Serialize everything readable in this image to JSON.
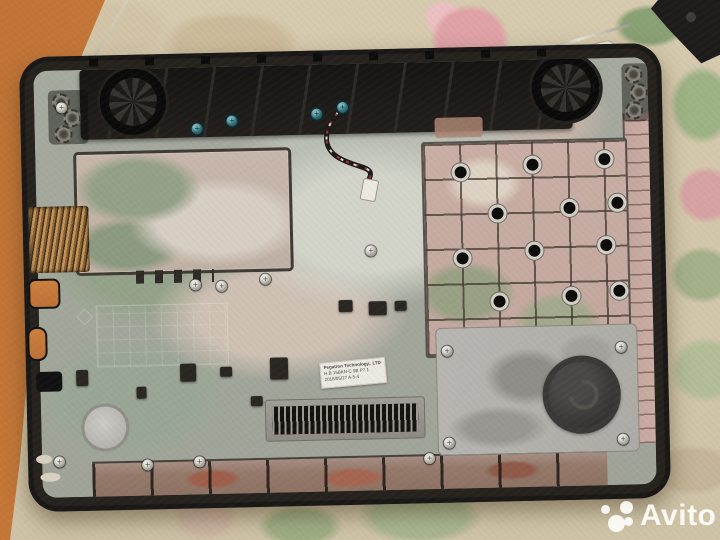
{
  "meta": {
    "type": "photograph",
    "subject": "Disassembled laptop bottom case, interior view, lying on a floral tablecloth (marketplace listing photo)"
  },
  "watermark": {
    "text": "Avito",
    "color": "#ffffff"
  },
  "label": {
    "line1": "Pegatron Technology.. LTD",
    "line2": "H.B 15BKN-C 9B P7.1",
    "line3": "2016/05/27 A-5-4"
  },
  "colors": {
    "tablecloth_base": "#d3c7ac",
    "rose_pink": "#dfa2a7",
    "leaf_green": "#93a87c",
    "orange_floor": "#c87a3b",
    "case_plastic": "#26231f",
    "interior_base": "#a4a89c",
    "pink_dust": "#c9aea5",
    "panel_gray": "#b6b4af",
    "copper_heatsink": "#b88d52"
  },
  "scene": {
    "waffle_holes": [
      [
        28,
        20
      ],
      [
        100,
        14
      ],
      [
        172,
        10
      ],
      [
        64,
        62
      ],
      [
        136,
        58
      ],
      [
        184,
        54
      ],
      [
        28,
        106
      ],
      [
        100,
        100
      ],
      [
        172,
        96
      ],
      [
        64,
        150
      ],
      [
        136,
        146
      ],
      [
        184,
        142
      ],
      [
        28,
        194
      ],
      [
        100,
        190
      ],
      [
        172,
        186
      ]
    ],
    "silver_screws": [
      [
        22,
        32
      ],
      [
        152,
        212
      ],
      [
        178,
        214
      ],
      [
        222,
        208
      ],
      [
        328,
        182
      ],
      [
        12,
        386
      ],
      [
        100,
        391
      ],
      [
        152,
        389
      ],
      [
        382,
        391
      ],
      [
        402,
        284
      ],
      [
        576,
        284
      ],
      [
        402,
        376
      ],
      [
        576,
        376
      ]
    ],
    "teal_screws": [
      [
        157,
        56
      ],
      [
        192,
        49
      ],
      [
        277,
        44
      ],
      [
        303,
        38
      ]
    ],
    "dark_parts": [
      [
        140,
        296,
        16,
        18
      ],
      [
        180,
        300,
        12,
        10
      ],
      [
        230,
        292,
        18,
        22
      ],
      [
        96,
        318,
        10,
        12
      ],
      [
        210,
        330,
        12,
        10
      ],
      [
        330,
        238,
        18,
        14
      ],
      [
        300,
        236,
        14,
        12
      ],
      [
        356,
        238,
        12,
        10
      ],
      [
        36,
        300,
        12,
        16
      ]
    ]
  }
}
